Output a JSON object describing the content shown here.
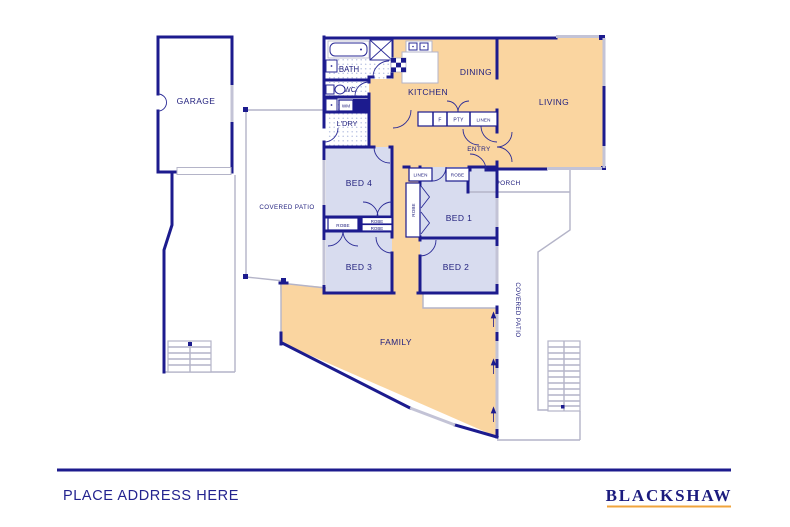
{
  "labels": {
    "garage": "GARAGE",
    "bath": "BATH",
    "wc": "WC",
    "wm": "WM",
    "ldry": "L'DRY",
    "kitchen": "KITCHEN",
    "dining": "DINING",
    "living": "LIVING",
    "fridge": "F",
    "pantry": "PTY",
    "linen": "LINEN",
    "entry": "ENTRY",
    "porch": "PORCH",
    "bed1": "BED 1",
    "bed2": "BED 2",
    "bed3": "BED 3",
    "bed4": "BED 4",
    "robe": "ROBE",
    "family": "FAMILY",
    "covered_patio": "COVERED PATIO"
  },
  "footer": {
    "address_placeholder": "PLACE ADDRESS HERE",
    "brand": "BLACKSHAW"
  },
  "colors": {
    "wall_navy": "#1c1b8e",
    "text_navy": "#23227f",
    "floor_orange": "#fad5a0",
    "floor_blue": "#d8dcef",
    "outline_gray": "#b4b4c8",
    "brand_gold": "#f0a43c"
  }
}
